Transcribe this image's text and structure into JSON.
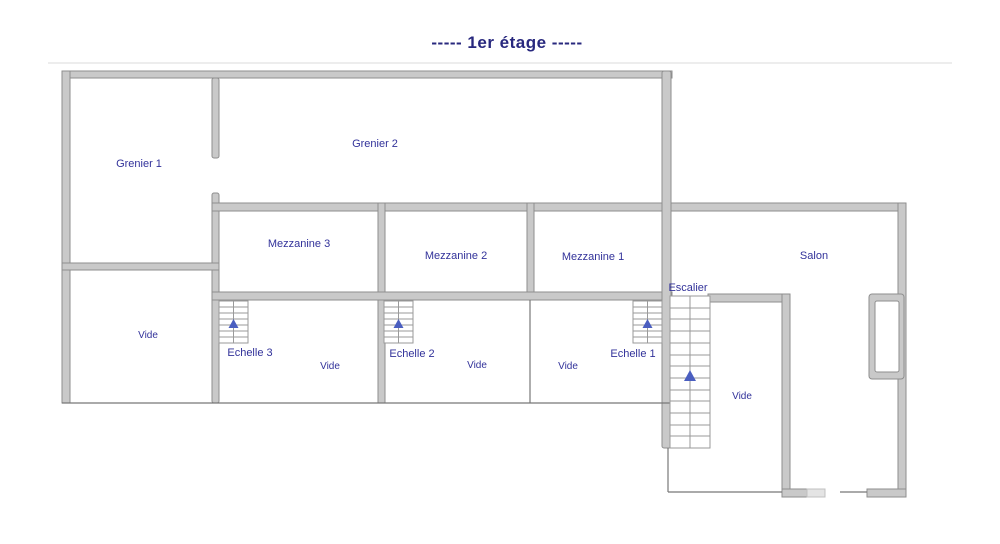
{
  "page": {
    "title": "----- 1er étage -----"
  },
  "rooms": {
    "grenier_1": "Grenier 1",
    "grenier_2": "Grenier 2",
    "mezzanine_3": "Mezzanine 3",
    "mezzanine_2": "Mezzanine 2",
    "mezzanine_1": "Mezzanine 1",
    "salon": "Salon",
    "escalier": "Escalier",
    "echelle_3": "Echelle 3",
    "echelle_2": "Echelle 2",
    "echelle_1": "Echelle 1",
    "vide": "Vide"
  },
  "symbols": {
    "stair_direction_arrow": "up",
    "ladder_direction_arrow": "up"
  },
  "colors": {
    "wall_fill": "#c9c9c9",
    "wall_edge": "#8e8e8e",
    "thin_line": "#777777",
    "label_text": "#32329a",
    "title_text": "#28287e",
    "arrow_blue": "#4a5ec0"
  }
}
